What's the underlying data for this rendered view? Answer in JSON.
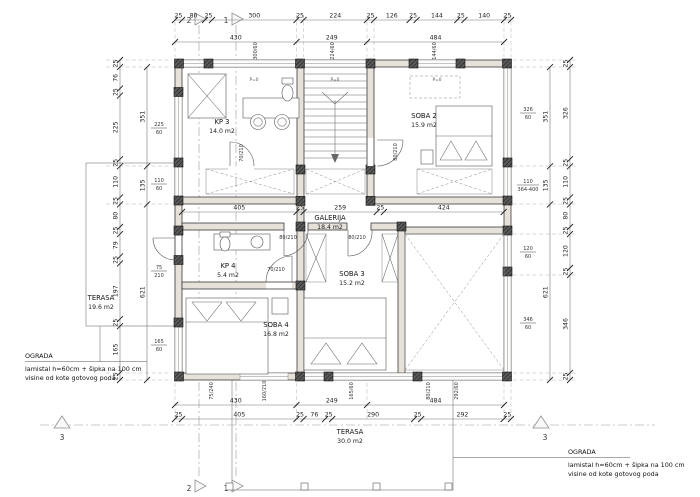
{
  "plan": {
    "rooms": {
      "kp3": {
        "name": "KP 3",
        "area": "14.0 m2"
      },
      "soba2": {
        "name": "SOBA 2",
        "area": "15.9 m2"
      },
      "galerija": {
        "name": "GALERIJA",
        "area": "18.4 m2"
      },
      "kp4": {
        "name": "KP 4",
        "area": "5.4 m2"
      },
      "soba3": {
        "name": "SOBA 3",
        "area": "15.2 m2"
      },
      "soba4": {
        "name": "SOBA 4",
        "area": "16.8 m2"
      },
      "terasa_upper": {
        "name": "TERASA",
        "area": "19.6 m2"
      },
      "terasa_lower": {
        "name": "TERASA",
        "area": "30.0 m2"
      }
    },
    "notes": {
      "ograda_left": {
        "title": "OGRADA",
        "line1": "lamistal h=60cm + šipka na 100 cm",
        "line2": "visine od kote gotovog poda"
      },
      "ograda_right": {
        "title": "OGRADA",
        "line1": "lamistal h=60cm + šipka na 100 cm",
        "line2": "visine od kote gotovog poda"
      }
    },
    "markers": {
      "s1": "1",
      "s2": "2",
      "s3": "3"
    },
    "dims": {
      "top_detail": [
        "25",
        "80",
        "25",
        "300",
        "25",
        "224",
        "25",
        "126",
        "25",
        "144",
        "25",
        "140",
        "25"
      ],
      "top_group": [
        "430",
        "249",
        "484"
      ],
      "bottom_group": [
        "430",
        "249",
        "484"
      ],
      "bottom_detail": [
        "25",
        "405",
        "25",
        "76",
        "25",
        "290",
        "25",
        "292",
        "25"
      ],
      "left_detail": [
        "25",
        "76",
        "25",
        "225",
        "25",
        "110",
        "25",
        "80",
        "25",
        "79",
        "25",
        "197",
        "25",
        "165",
        "25"
      ],
      "left_group": [
        "351",
        "135",
        "621"
      ],
      "right_group": [
        "351",
        "135",
        "621"
      ],
      "right_detail": [
        "25",
        "326",
        "25",
        "110",
        "25",
        "80",
        "25",
        "120",
        "25",
        "346",
        "25"
      ],
      "mid": [
        "405",
        "25",
        "259",
        "25",
        "424"
      ]
    },
    "openings": {
      "top": [
        "300/60",
        "224/60",
        "144/60"
      ],
      "left": [
        {
          "t": "225",
          "b": "60"
        },
        {
          "t": "110",
          "b": "60"
        },
        {
          "t": "75",
          "b": "210"
        },
        {
          "t": "165",
          "b": "60"
        }
      ],
      "right": [
        {
          "t": "326",
          "b": "60"
        },
        {
          "t": "110",
          "b": "364-400"
        },
        {
          "t": "120",
          "b": "60"
        },
        {
          "t": "346",
          "b": "60"
        }
      ],
      "bottom": [
        "75/240",
        "160/210",
        "165/60",
        "80/210",
        "292/60"
      ],
      "doors": [
        "70/210",
        "80/210",
        "80/210",
        "80/210",
        "70/210"
      ],
      "parapet": "P=0"
    }
  }
}
